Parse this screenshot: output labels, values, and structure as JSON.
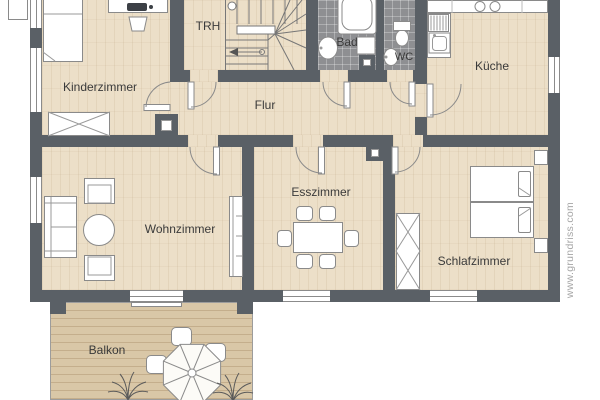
{
  "floorplan": {
    "rooms": [
      {
        "name": "kinderzimmer",
        "label": "Kinderzimmer"
      },
      {
        "name": "trh",
        "label": "TRH"
      },
      {
        "name": "bad",
        "label": "Bad"
      },
      {
        "name": "wc",
        "label": "WC"
      },
      {
        "name": "kueche",
        "label": "Küche"
      },
      {
        "name": "flur",
        "label": "Flur"
      },
      {
        "name": "wohnzimmer",
        "label": "Wohnzimmer"
      },
      {
        "name": "esszimmer",
        "label": "Esszimmer"
      },
      {
        "name": "schlafzimmer",
        "label": "Schlafzimmer"
      },
      {
        "name": "balkon",
        "label": "Balkon"
      }
    ],
    "watermark": "www.grundriss.com",
    "colors": {
      "wall": "#5a6066",
      "floor_wood": "#ecdfc8",
      "floor_tile": "#8e8f92",
      "balcony_deck": "#d9c7a7",
      "fixture_stroke": "#8a8a8a",
      "label_text": "#3a3a3a",
      "watermark_text": "#a6a6a6"
    }
  }
}
